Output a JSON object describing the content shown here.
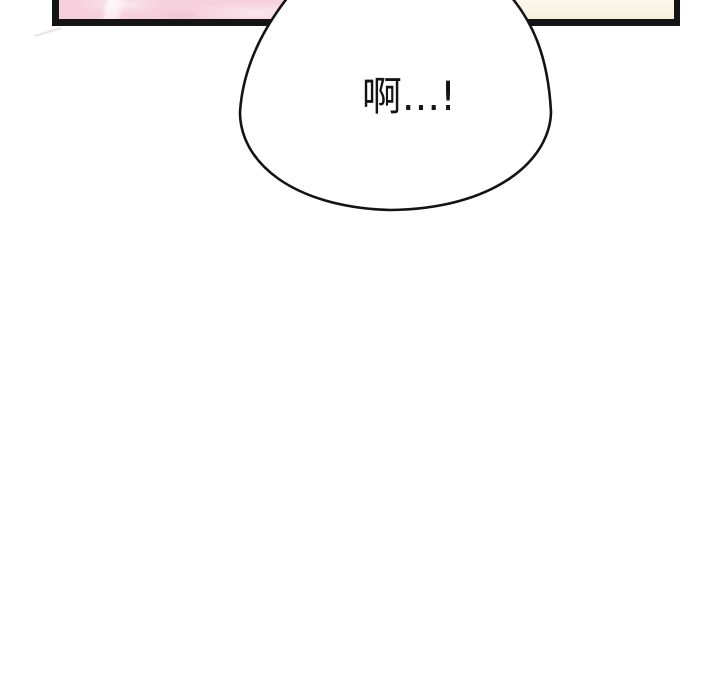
{
  "colors": {
    "page-bg": "#ffffff",
    "ink": "#141414",
    "panel-pink": "#f6d1dd",
    "panel-pink-light": "#fbe6ec",
    "panel-cream": "#faf4e2",
    "bubble-fill": "#ffffff",
    "text-color": "#141414"
  },
  "speech_bubble": {
    "text": "啊...!"
  }
}
